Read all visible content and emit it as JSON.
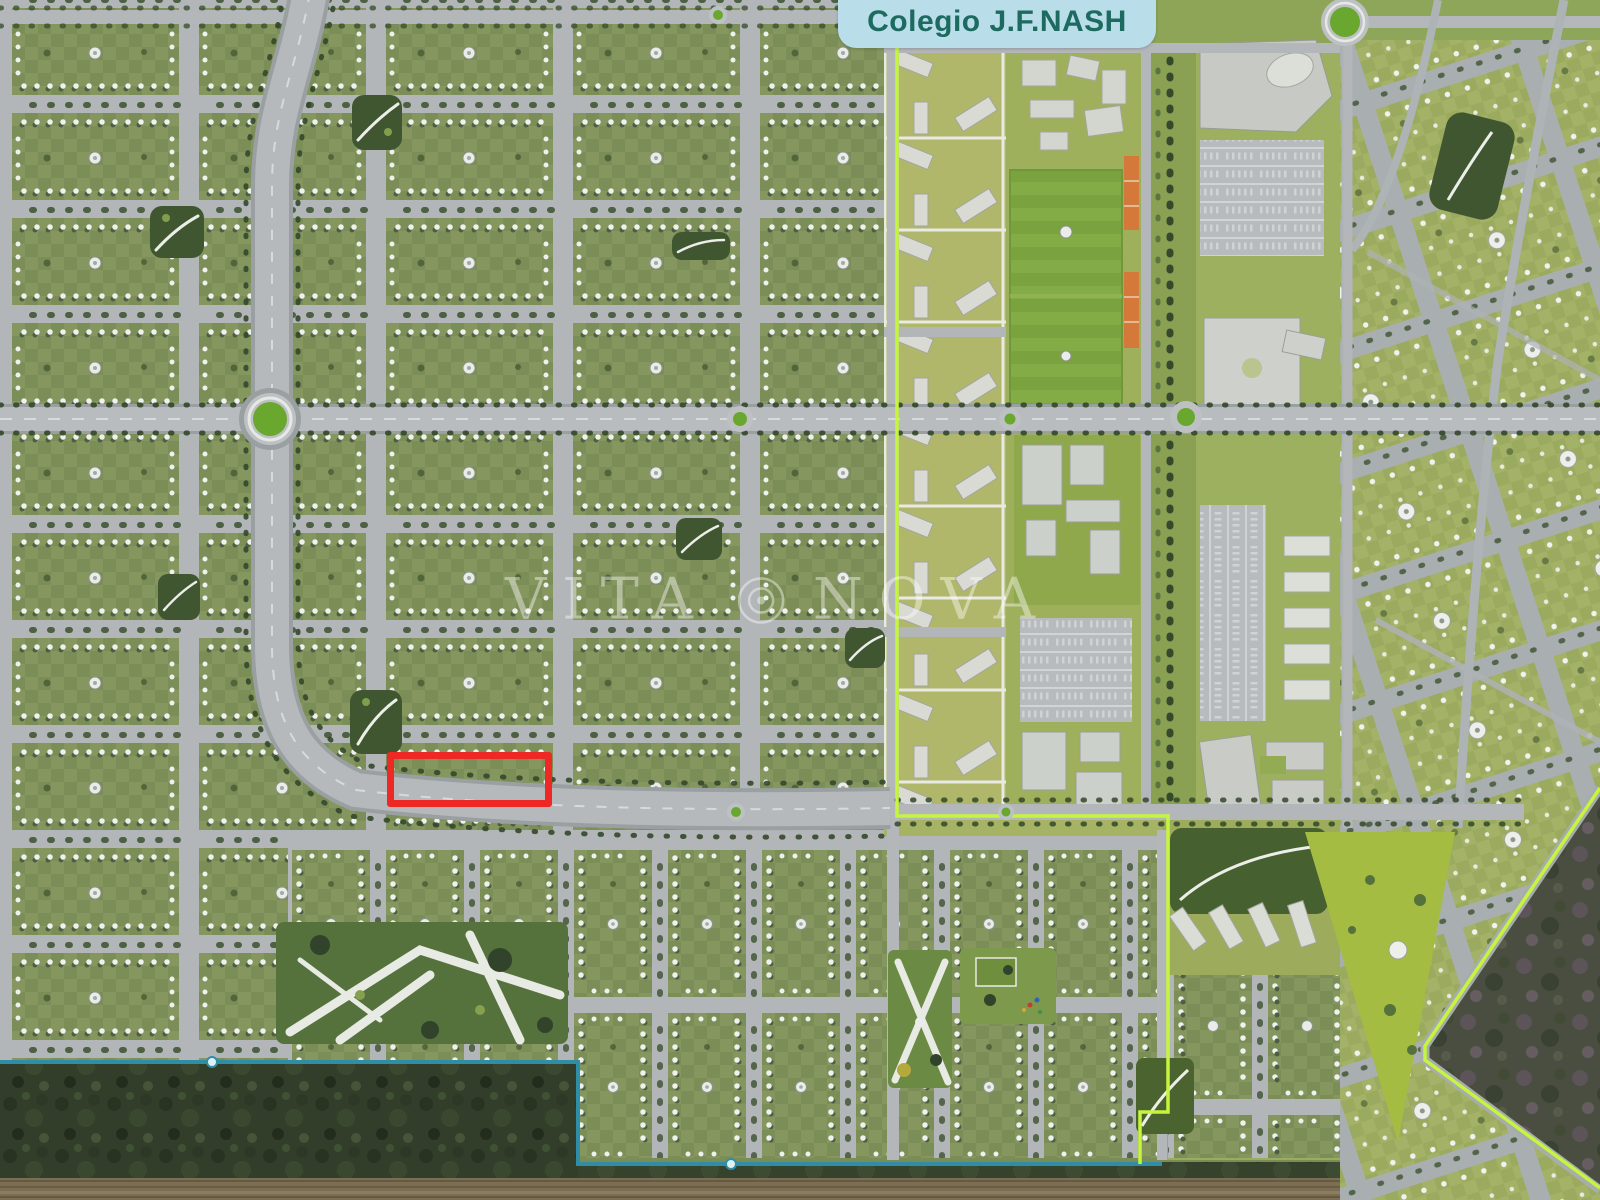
{
  "map_label": {
    "text": "Colegio J.F.NASH",
    "bg": "#b9dde9",
    "text_color": "#1c6a60"
  },
  "watermark": {
    "left": "VITA",
    "right": "NOVA",
    "logo": "concentric-circle-logo",
    "opacity": 0.42
  },
  "highlight": {
    "x": 387,
    "y": 752,
    "width": 165,
    "height": 55,
    "color": "#ee2824",
    "stroke_width": 7
  },
  "palette": {
    "base_green": "#7b8d56",
    "lawn_checker_light": "#85975f",
    "road_gray": "#b2b6b9",
    "strip_green": "#a6b364",
    "campus_building_gray": "#c9ccc6",
    "sports_pitch_green": "#7aa33f",
    "court_orange": "#d5793a",
    "boundary_lime": "#c6f53e",
    "boundary_teal": "#2f8da6",
    "forest_dark": "#323e2a",
    "field_brown": "#7c6e52",
    "roundabout_green": "#6aa72f",
    "tree_dot_white": "#eff1ee"
  }
}
